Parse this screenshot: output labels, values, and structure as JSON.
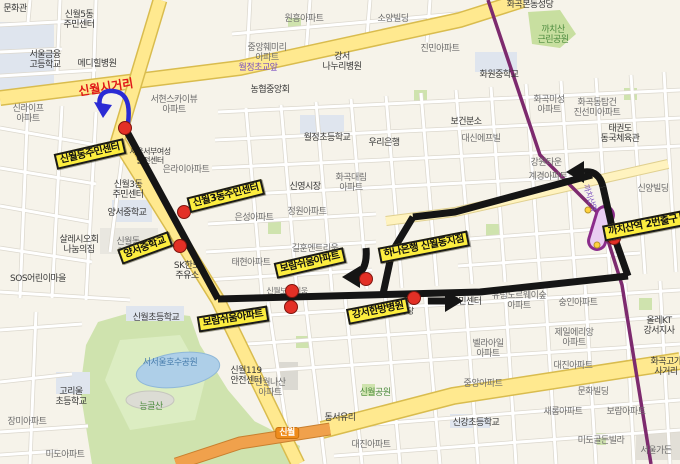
{
  "map": {
    "background_color": "#f6f3ea",
    "road_color_major": "#ffe98f",
    "road_color_expressway": "#f0a14c",
    "subway_line_color": "#7d2a6e",
    "poi_labels": [
      {
        "t": "문화관",
        "x": 15,
        "y": 9,
        "c": "d"
      },
      {
        "t": "신월5동\n주민센터",
        "x": 79,
        "y": 20,
        "c": "d"
      },
      {
        "t": "서울금융\n고등학교",
        "x": 45,
        "y": 60,
        "c": "d"
      },
      {
        "t": "메디힐병원",
        "x": 97,
        "y": 64,
        "c": "d"
      },
      {
        "t": "신라이프\n아파트",
        "x": 28,
        "y": 114,
        "c": "g"
      },
      {
        "t": "서현스카이뷰\n아파트",
        "x": 174,
        "y": 105,
        "c": "g"
      },
      {
        "t": "원흥아파트",
        "x": 304,
        "y": 19,
        "c": "g"
      },
      {
        "t": "소양빌딩",
        "x": 393,
        "y": 19,
        "c": "g"
      },
      {
        "t": "중앙훼미리\n아파트",
        "x": 267,
        "y": 53,
        "c": "g"
      },
      {
        "t": "강서\n나누리병원",
        "x": 342,
        "y": 62,
        "c": "d"
      },
      {
        "t": "진민아파트",
        "x": 440,
        "y": 49,
        "c": "g"
      },
      {
        "t": "농협중앙회",
        "x": 270,
        "y": 90,
        "c": "d"
      },
      {
        "t": "월정초등학교",
        "x": 327,
        "y": 138,
        "c": "d"
      },
      {
        "t": "우리은행",
        "x": 384,
        "y": 143,
        "c": "d"
      },
      {
        "t": "화곡본동성당",
        "x": 530,
        "y": 5,
        "c": "d"
      },
      {
        "t": "까치산\n근린공원",
        "x": 553,
        "y": 35,
        "c": "green"
      },
      {
        "t": "화원중학교",
        "x": 499,
        "y": 75,
        "c": "d"
      },
      {
        "t": "화곡미성\n아파트",
        "x": 549,
        "y": 105,
        "c": "g"
      },
      {
        "t": "화곡동탑건\n진선미아파트",
        "x": 597,
        "y": 108,
        "c": "g"
      },
      {
        "t": "태권도\n동국체육관",
        "x": 620,
        "y": 134,
        "c": "d"
      },
      {
        "t": "보건분소",
        "x": 466,
        "y": 122,
        "c": "d"
      },
      {
        "t": "대신에프빌",
        "x": 481,
        "y": 139,
        "c": "g"
      },
      {
        "t": "서울서부여성\n발전센터",
        "x": 150,
        "y": 157,
        "c": "d",
        "s": 8
      },
      {
        "t": "은라이아파트",
        "x": 186,
        "y": 170,
        "c": "g"
      },
      {
        "t": "신월3동\n주민센터",
        "x": 128,
        "y": 190,
        "c": "d"
      },
      {
        "t": "양서중학교",
        "x": 127,
        "y": 213,
        "c": "d"
      },
      {
        "t": "살레시오회\n나눔의집",
        "x": 79,
        "y": 245,
        "c": "d"
      },
      {
        "t": "신월동\n2단지",
        "x": 128,
        "y": 247,
        "c": "g"
      },
      {
        "t": "SOS어린이마을",
        "x": 38,
        "y": 279,
        "c": "d"
      },
      {
        "t": "SK한도\n주유소",
        "x": 187,
        "y": 271,
        "c": "d"
      },
      {
        "t": "은성아파트",
        "x": 254,
        "y": 218,
        "c": "g"
      },
      {
        "t": "신영시장",
        "x": 305,
        "y": 187,
        "c": "d"
      },
      {
        "t": "화곡대림\n아파트",
        "x": 351,
        "y": 183,
        "c": "g"
      },
      {
        "t": "정원아파트",
        "x": 307,
        "y": 212,
        "c": "g"
      },
      {
        "t": "길훈엔트리움",
        "x": 315,
        "y": 249,
        "c": "g"
      },
      {
        "t": "태현아파트",
        "x": 251,
        "y": 263,
        "c": "g"
      },
      {
        "t": "신월보람쉬움",
        "x": 287,
        "y": 292,
        "c": "g",
        "s": 8
      },
      {
        "t": "강원타운",
        "x": 546,
        "y": 163,
        "c": "g"
      },
      {
        "t": "계경아파트",
        "x": 548,
        "y": 177,
        "c": "g"
      },
      {
        "t": "신양빌딩",
        "x": 653,
        "y": 189,
        "c": "g"
      },
      {
        "t": "유림노르웨이숲\n아파트",
        "x": 519,
        "y": 301,
        "c": "g"
      },
      {
        "t": "숭인아파트",
        "x": 578,
        "y": 303,
        "c": "g"
      },
      {
        "t": "주민센터",
        "x": 466,
        "y": 302,
        "c": "d"
      },
      {
        "t": "신월성당",
        "x": 400,
        "y": 312,
        "c": "d",
        "s": 8
      },
      {
        "t": "신월초등학교",
        "x": 156,
        "y": 318,
        "c": "d"
      },
      {
        "t": "서서울호수공원",
        "x": 170,
        "y": 363,
        "c": "b"
      },
      {
        "t": "고리울\n초등학교",
        "x": 71,
        "y": 397,
        "c": "d"
      },
      {
        "t": "능골산",
        "x": 151,
        "y": 407,
        "c": "green"
      },
      {
        "t": "장미아파트",
        "x": 27,
        "y": 422,
        "c": "g"
      },
      {
        "t": "미도아파트",
        "x": 65,
        "y": 455,
        "c": "g"
      },
      {
        "t": "신월119\n안전센터",
        "x": 246,
        "y": 376,
        "c": "d"
      },
      {
        "t": "신월나산\n아파트",
        "x": 270,
        "y": 388,
        "c": "g"
      },
      {
        "t": "신월공원",
        "x": 375,
        "y": 393,
        "c": "green"
      },
      {
        "t": "동서유리",
        "x": 340,
        "y": 418,
        "c": "d"
      },
      {
        "t": "대진아파트",
        "x": 371,
        "y": 445,
        "c": "g"
      },
      {
        "t": "제일에리앙\n아파트",
        "x": 574,
        "y": 338,
        "c": "g"
      },
      {
        "t": "올레KT\n강서지사",
        "x": 659,
        "y": 326,
        "c": "d"
      },
      {
        "t": "벨라아일\n아파트",
        "x": 488,
        "y": 349,
        "c": "g"
      },
      {
        "t": "대진아파트",
        "x": 573,
        "y": 366,
        "c": "g"
      },
      {
        "t": "화곡고가\n사거리",
        "x": 666,
        "y": 367,
        "c": "d"
      },
      {
        "t": "중앙아파트",
        "x": 483,
        "y": 384,
        "c": "g"
      },
      {
        "t": "문화빌딩",
        "x": 593,
        "y": 392,
        "c": "g"
      },
      {
        "t": "새롬아파트",
        "x": 563,
        "y": 412,
        "c": "g"
      },
      {
        "t": "보람아파트",
        "x": 626,
        "y": 412,
        "c": "g"
      },
      {
        "t": "신강초등학교",
        "x": 476,
        "y": 423,
        "c": "d"
      },
      {
        "t": "미도골든빌라",
        "x": 601,
        "y": 441,
        "c": "g"
      },
      {
        "t": "서울가든",
        "x": 656,
        "y": 451,
        "c": "g"
      },
      {
        "t": "월정초교앞",
        "x": 258,
        "y": 68,
        "c": "p"
      },
      {
        "t": "신월시거리",
        "x": 106,
        "y": 88,
        "c": "r",
        "s": 12,
        "r": -9
      },
      {
        "t": "까치산역",
        "x": 589,
        "y": 198,
        "c": "p",
        "s": 8,
        "r": 72
      },
      {
        "t": "신월",
        "x": 287,
        "y": 433,
        "c": "w"
      }
    ]
  },
  "route": {
    "color": "#151515",
    "width": 7,
    "segments": [
      "M125,128 L218,299",
      "M218,299 L480,292 L628,276",
      "M628,276 L614,236 L603,187",
      "M603,187 Q599,170 584,172",
      "M592,175 L455,212 L413,217",
      "M413,217 L392,252 L383,294",
      "M366,248 Q368,270 355,276",
      "M428,301 L448,301"
    ],
    "arrowheads": [
      {
        "points": "566,172 584,161 584,183",
        "name": "turn-left-arrowhead-icon"
      },
      {
        "points": "342,277 360,266 360,288",
        "name": "turn-down-arrowhead-icon"
      },
      {
        "points": "463,301 445,290 445,312",
        "name": "go-right-arrowhead-icon"
      }
    ],
    "stops": [
      [
        125,
        128
      ],
      [
        184,
        212
      ],
      [
        180,
        246
      ],
      [
        292,
        291
      ],
      [
        291,
        307
      ],
      [
        366,
        279
      ],
      [
        414,
        298
      ],
      [
        614,
        238
      ]
    ],
    "stop_color": "#e33026",
    "uturn_arrow": {
      "path": "M128,123 C131,100 124,92 113,91 C101,90 97,99 101,110",
      "head": "103,118 94,102 112,105",
      "color": "#2b2bd4"
    },
    "landmark_labels": [
      {
        "t": "신월동주민센터",
        "x": 90,
        "y": 154,
        "r": -13
      },
      {
        "t": "신월3동주민센터",
        "x": 226,
        "y": 196,
        "r": -14
      },
      {
        "t": "양서중학교",
        "x": 145,
        "y": 248,
        "r": -20
      },
      {
        "t": "보람쉬움아파트",
        "x": 310,
        "y": 263,
        "r": -13
      },
      {
        "t": "하나은행 신월동지점",
        "x": 424,
        "y": 247,
        "r": -11
      },
      {
        "t": "강서한방병원",
        "x": 378,
        "y": 311,
        "r": -11
      },
      {
        "t": "보람쉬움아파트",
        "x": 233,
        "y": 319,
        "r": -9
      },
      {
        "t": "까치산역 2번출구",
        "x": 643,
        "y": 226,
        "r": -11
      }
    ],
    "label_bg": "#fced3f"
  }
}
